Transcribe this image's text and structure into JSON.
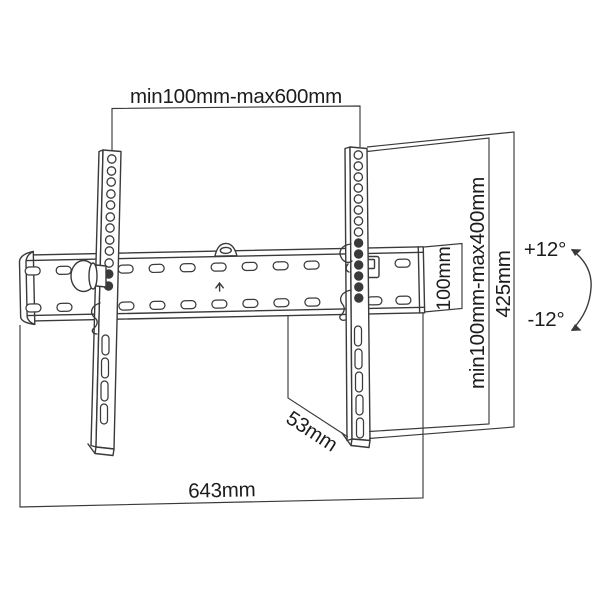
{
  "diagram": {
    "labels": {
      "top_width": "min100mm-max600mm",
      "vesa_height": "min100mm-max400mm",
      "total_height": "425mm",
      "plate_height": "100mm",
      "tilt_up": "+12°",
      "tilt_down": "-12°",
      "depth": "53mm",
      "total_width": "643mm"
    },
    "colors": {
      "line": "#3a3a3a",
      "text": "#1c1c1c",
      "background": "#ffffff"
    }
  }
}
